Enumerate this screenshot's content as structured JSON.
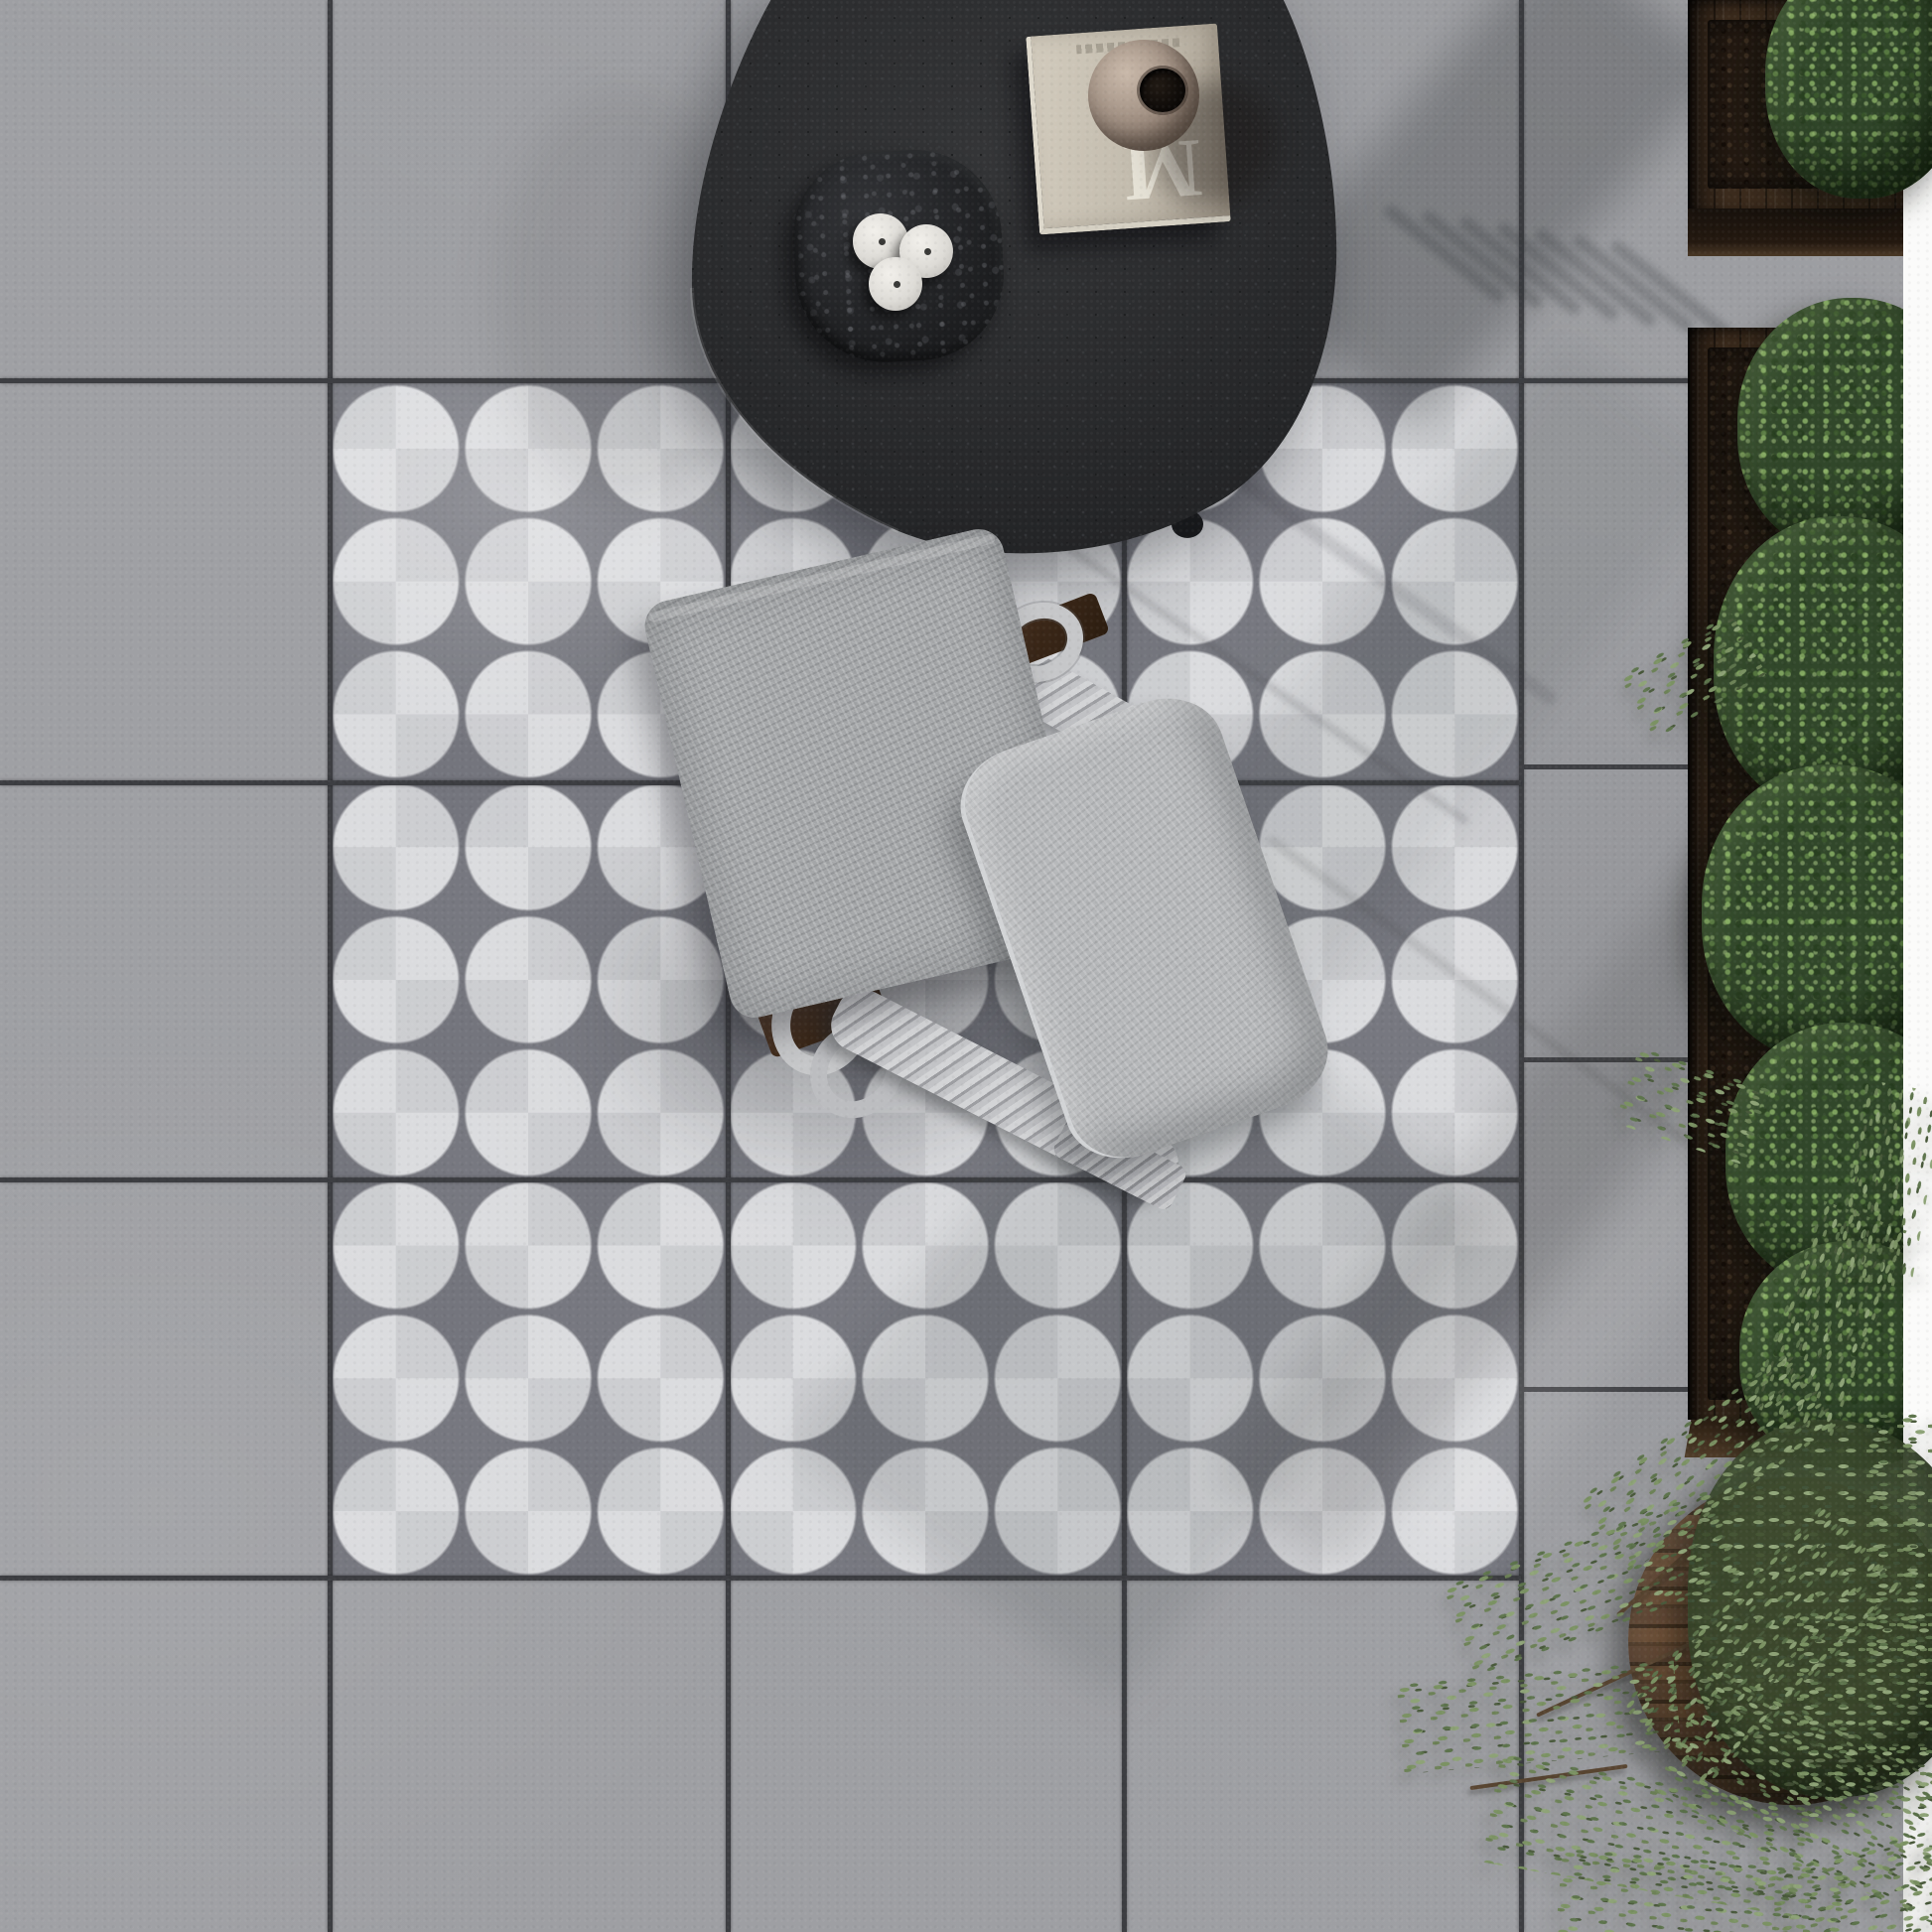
{
  "scene": {
    "type": "top-down outdoor patio photograph",
    "book": {
      "letter_top": "E",
      "letter_bottom": "M"
    },
    "objects": [
      "concrete-paver-floor",
      "circle-star-pattern-tile-inlay",
      "black-organic-coffee-table",
      "stone-tray",
      "white-candles-x3",
      "linen-book",
      "sphere-ceramic-vase",
      "rope-weave-armchair",
      "seat-cushion",
      "back-pillow",
      "dark-wood-planter-boxes",
      "boxwood-hedge",
      "round-timber-planter",
      "olive-tree"
    ]
  },
  "palette": {
    "tile": "#a3a4a8",
    "grout": "#3d3e42",
    "pattern_light": "#c9cacd",
    "pattern_dark": "#b0b1b5",
    "pattern_star": "#84858b",
    "table_black": "#2b2c2e",
    "tray": "#1d1e20",
    "book_cover": "#c2bbad",
    "vase": "#9b8a7d",
    "rope": "#c6c7c9",
    "cushion": "#a4a6a8",
    "pillow": "#b6b8ba",
    "planter_wood": "#3b2b1d",
    "hedge_green": "#31472a",
    "olive_green": "#6d8257",
    "margin_white": "#fbfbfa"
  }
}
